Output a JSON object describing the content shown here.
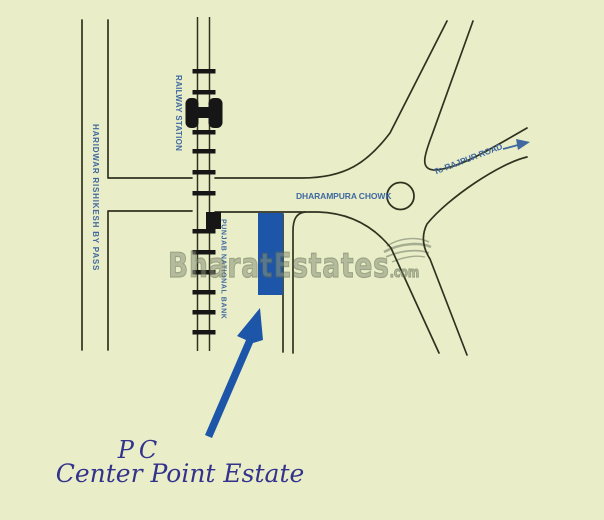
{
  "colors": {
    "background": "#e9eec9",
    "road": "#30321f",
    "ink_black": "#161616",
    "marker_blue": "#1d55a8",
    "label_blue": "#40699f",
    "script_blue": "#34338c",
    "watermark_gray": "#8a9378",
    "swirl_gray": "#99a287"
  },
  "map": {
    "road_labels": {
      "bypass": "HARIDWAR RISHIKESH BY PASS",
      "railway_station": "RAILWAY STATION",
      "bank": "PUNJAB NATIONAL BANK",
      "chowk": "DHARAMPURA CHOWK",
      "rajpur": "To RAJPUR ROAD"
    },
    "property": {
      "monogram": "PC",
      "name": "Center Point Estate"
    },
    "watermark": {
      "brand": "BharatEstates",
      "tld": ".com"
    }
  }
}
